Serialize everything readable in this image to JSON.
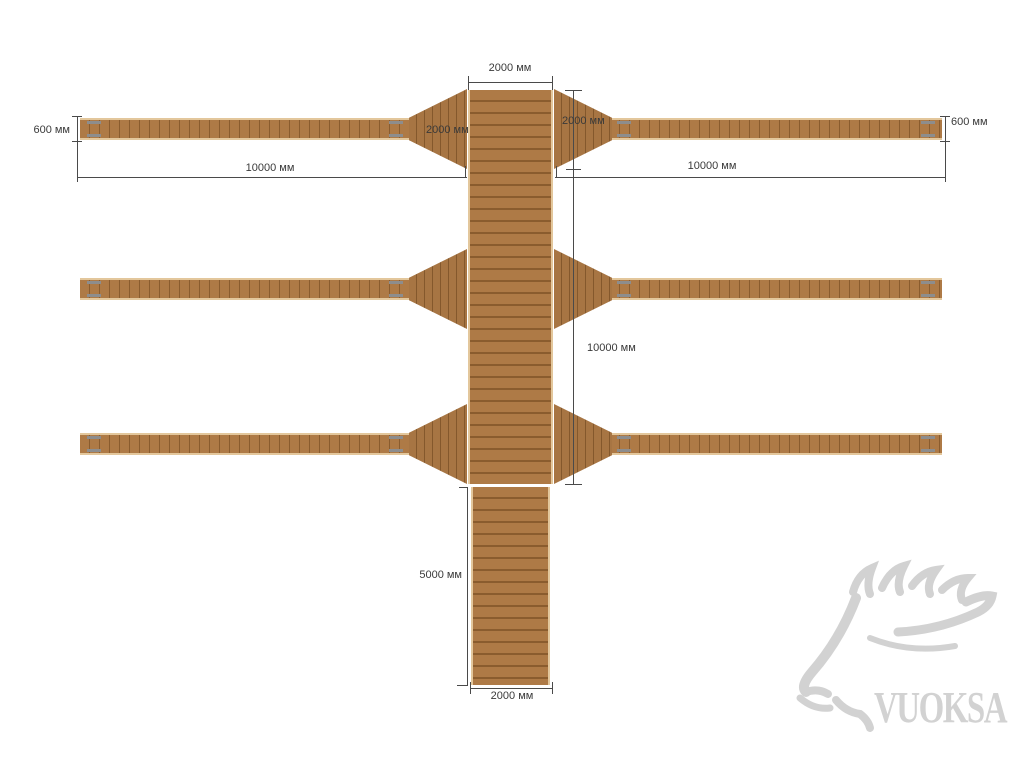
{
  "diagram": {
    "type": "wooden-dock-plan-drawing",
    "unit": "мм",
    "dimensions": {
      "top_width": "2000 мм",
      "top_left_transition": "2000 мм",
      "top_right_transition": "2000 мм",
      "left_finger_width": "600 мм",
      "right_finger_width": "600 мм",
      "left_finger_length": "10000 мм",
      "right_finger_length": "10000 мм",
      "main_walkway_length": "10000 мм",
      "bottom_extension_length": "5000 мм",
      "bottom_extension_width": "2000 мм"
    },
    "colors": {
      "wood_base": "#ae7a46",
      "wood_dark": "#8a5c2e",
      "wood_edge_light": "#e3c79c",
      "dimension_line": "#4a4a4a",
      "hinge_metal": "#8d8d8d",
      "watermark_color": "#d2d2d2"
    }
  },
  "watermark": {
    "text": "VUOKSA",
    "logo": "moose-head-icon"
  }
}
